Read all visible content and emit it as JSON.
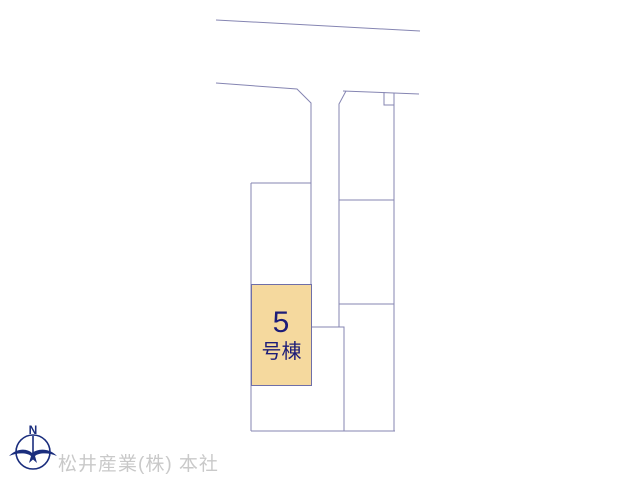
{
  "page": {
    "background": "#ffffff",
    "width": 640,
    "height": 480
  },
  "site_plan": {
    "line_color": "#8585b2",
    "lines": [
      {
        "name": "road-edge-top",
        "points": [
          [
            216,
            20
          ],
          [
            420,
            31
          ]
        ]
      },
      {
        "name": "block-west-boundary",
        "points": [
          [
            216,
            83
          ],
          [
            297,
            89
          ],
          [
            311,
            103
          ],
          [
            311,
            385
          ]
        ]
      },
      {
        "name": "lot-a-top-edge",
        "points": [
          [
            251,
            183
          ],
          [
            311,
            183
          ]
        ]
      },
      {
        "name": "block-west-edge",
        "points": [
          [
            251,
            183
          ],
          [
            251,
            431
          ]
        ]
      },
      {
        "name": "block-bottom-edge",
        "points": [
          [
            251,
            431
          ],
          [
            395,
            431
          ]
        ]
      },
      {
        "name": "inner-step-boundary",
        "points": [
          [
            311,
            327
          ],
          [
            344,
            327
          ],
          [
            344,
            431
          ]
        ]
      },
      {
        "name": "right-column-west-edge",
        "points": [
          [
            346,
            91
          ],
          [
            339,
            104
          ],
          [
            339,
            327
          ]
        ]
      },
      {
        "name": "right-column-north-edge",
        "points": [
          [
            343,
            91
          ],
          [
            419,
            94
          ]
        ]
      },
      {
        "name": "boundary-notch",
        "points": [
          [
            384,
            92
          ],
          [
            384,
            105
          ],
          [
            394,
            105
          ]
        ]
      },
      {
        "name": "right-column-east-edge",
        "points": [
          [
            394,
            93
          ],
          [
            394,
            431
          ]
        ]
      },
      {
        "name": "right-column-divider-1",
        "points": [
          [
            339,
            200
          ],
          [
            394,
            200
          ]
        ]
      },
      {
        "name": "right-column-divider-2",
        "points": [
          [
            339,
            304
          ],
          [
            394,
            304
          ]
        ]
      }
    ]
  },
  "highlight_lot": {
    "number": "5",
    "suffix": "号棟",
    "fill": "#f5d99e",
    "border": "#6f6fa8",
    "text_color": "#1c1c78",
    "x": 251,
    "y": 284,
    "width": 61,
    "height": 102
  },
  "footer": {
    "company_text": "松井産業(株) 本社",
    "text_color": "#c9c9c9",
    "compass": {
      "north_label": "N",
      "color": "#1a2d7d"
    }
  }
}
